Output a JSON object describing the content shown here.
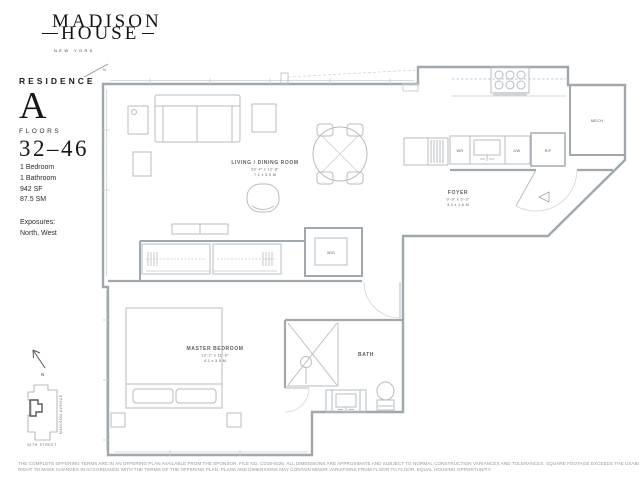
{
  "brand": {
    "name_top": "MADISON",
    "name_bottom": "HOUSE",
    "city": "NEW YORK"
  },
  "residence": {
    "label": "RESIDENCE",
    "unit": "A",
    "floors_label": "FLOORS",
    "floors": "32–46",
    "specs": [
      "1 Bedroom",
      "1 Bathroom",
      "942 SF",
      "87.5 SM"
    ],
    "exposures_label": "Exposures:",
    "exposures_value": "North, West"
  },
  "plan": {
    "compass": {
      "west": "W",
      "north": "N"
    },
    "living": {
      "name": "LIVING / DINING ROOM",
      "imperial": "23'-4\" x 12'-8\"",
      "metric": "7.1 x 3.9 M"
    },
    "foyer": {
      "name": "FOYER",
      "imperial": "9'-9\" x 5'-3\"",
      "metric": "3.0 x 1.6 M"
    },
    "bedroom": {
      "name": "MASTER BEDROOM",
      "imperial": "13'-2\" x 11'-6\"",
      "metric": "4.1 x 3.5 M"
    },
    "bath": {
      "name": "BATH"
    },
    "mech": {
      "name": "MECH"
    },
    "appliances": {
      "wr": "WR",
      "dw": "DW",
      "rf": "R/F",
      "wd": "W/D"
    }
  },
  "key_plan": {
    "north": "N",
    "avenue": "MADISON AVENUE",
    "street": "30TH STREET"
  },
  "disclaimer": {
    "line1": "THE COMPLETE OFFERING TERMS ARE IN AN OFFERING PLAN AVAILABLE FROM THE SPONSOR. FILE NO. CD18-0026. ALL DIMENSIONS ARE APPROXIMATE AND SUBJECT TO NORMAL CONSTRUCTION VARIANCES AND TOLERANCES. SQUARE FOOTAGE EXCEEDS THE USABLE FLOOR AREA. SPONSOR RESERVES THE",
    "line2": "RIGHT TO MAKE CHANGES IN ACCORDANCE WITH THE TERMS OF THE OFFERING PLAN. PLANS AND DIMENSIONS MAY CONTAIN MINOR VARIATIONS FROM FLOOR TO FLOOR. EQUAL HOUSING OPPORTUNITY."
  }
}
